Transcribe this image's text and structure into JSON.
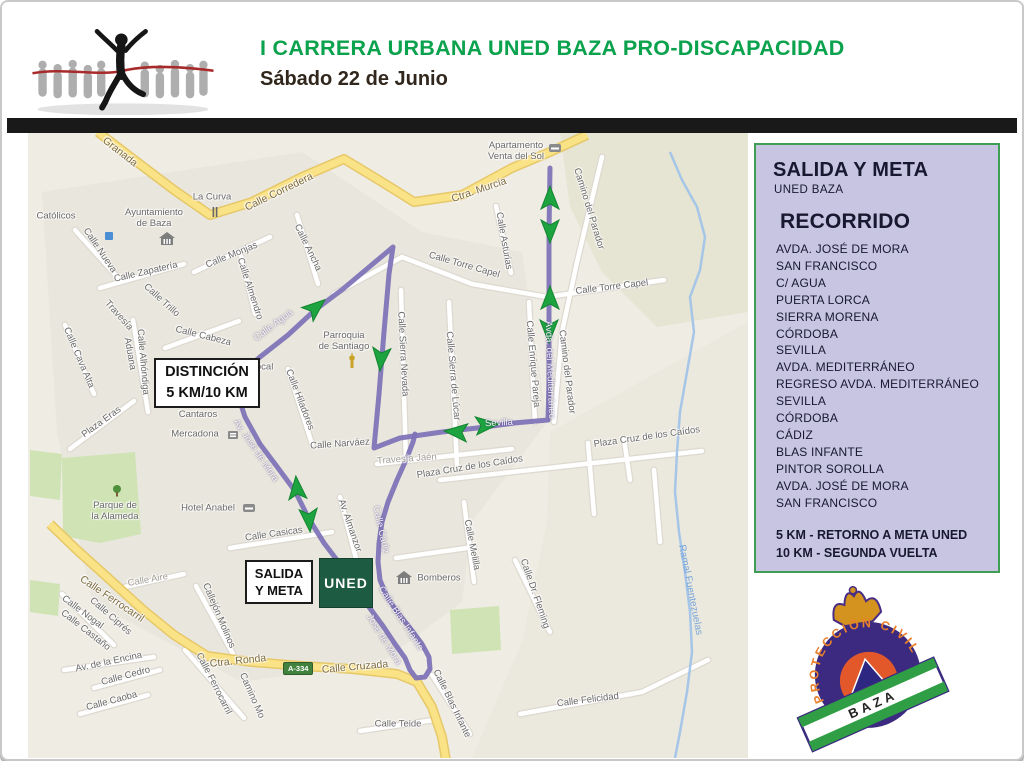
{
  "header": {
    "title": "I CARRERA URBANA UNED BAZA PRO-DISCAPACIDAD",
    "subtitle": "Sábado 22 de Junio"
  },
  "sidebar": {
    "heading": "SALIDA Y META",
    "subheading": "UNED BAZA",
    "recorrido_title": "RECORRIDO",
    "streets": [
      "AVDA. JOSÉ DE MORA",
      "SAN FRANCISCO",
      "C/ AGUA",
      "PUERTA LORCA",
      "SIERRA MORENA",
      "CÓRDOBA",
      "SEVILLA",
      "AVDA. MEDITERRÁNEO",
      "REGRESO AVDA. MEDITERRÁNEO",
      "SEVILLA",
      "CÓRDOBA",
      "CÁDIZ",
      "BLAS INFANTE",
      "PINTOR SOROLLA",
      "AVDA. JOSÉ DE MORA",
      "SAN FRANCISCO"
    ],
    "notes": [
      "5 KM - RETORNO A META UNED",
      "10 KM - SEGUNDA VUELTA"
    ]
  },
  "logo": {
    "arc_text": "PROTECCIÓN CIVIL",
    "banner_text": "BAZA"
  },
  "colors": {
    "title_green": "#0ba24d",
    "route_purple": "#7e72b7",
    "arrow_green": "#1da33f",
    "arrow_edge": "#12842f",
    "road_fill": "#fae286",
    "road_edge": "#e6c869",
    "street_white": "#ffffff",
    "street_edge": "#ddd9d0",
    "stream_blue": "#a6c6e8",
    "park_green": "#cfe3b4",
    "sidebar_bg": "#c7c5e2",
    "sidebar_border": "#3f9e53",
    "uned_green": "#1e5b43"
  },
  "map": {
    "boxes": {
      "distincion": {
        "line1": "DISTINCIÓN",
        "line2": "5 KM/10 KM"
      },
      "salida": {
        "line1": "SALIDA",
        "line2": "Y META"
      },
      "uned": "UNED",
      "road_badge": "A-334"
    },
    "labels": [
      {
        "t": "Granada",
        "x": 118,
        "y": 150,
        "r": 38,
        "c": "yellow"
      },
      {
        "t": "La Curva",
        "x": 210,
        "y": 196,
        "r": 0
      },
      {
        "t": "Calle Corredera",
        "x": 277,
        "y": 190,
        "r": -26,
        "c": "yellow"
      },
      {
        "t": "Ctra. Murcia",
        "x": 477,
        "y": 188,
        "r": -19,
        "c": "yellow"
      },
      {
        "t": "Católicos",
        "x": 54,
        "y": 215,
        "r": 0
      },
      {
        "t": "Ayuntamiento\nde Baza",
        "x": 152,
        "y": 217,
        "r": 0
      },
      {
        "t": "Calle Nueva",
        "x": 97,
        "y": 249,
        "r": 56
      },
      {
        "t": "Calle Zapatería",
        "x": 144,
        "y": 271,
        "r": -13
      },
      {
        "t": "Calle Monjas",
        "x": 230,
        "y": 254,
        "r": -22
      },
      {
        "t": "Calle Almendro",
        "x": 247,
        "y": 287,
        "r": 72
      },
      {
        "t": "Calle Ancha",
        "x": 305,
        "y": 246,
        "r": 64
      },
      {
        "t": "Calle Torre Capel",
        "x": 462,
        "y": 264,
        "r": 16
      },
      {
        "t": "Calle Torre Capel",
        "x": 610,
        "y": 286,
        "r": -7
      },
      {
        "t": "Calle Asturias",
        "x": 501,
        "y": 239,
        "r": 80
      },
      {
        "t": "Apartamento\nVenta del Sol",
        "x": 514,
        "y": 150,
        "r": 0
      },
      {
        "t": "Camino del Parador",
        "x": 586,
        "y": 207,
        "r": 73
      },
      {
        "t": "Camino del Parador",
        "x": 564,
        "y": 370,
        "r": 83
      },
      {
        "t": "Calle Enrique Pareja",
        "x": 530,
        "y": 362,
        "r": 85
      },
      {
        "t": "Plaza Cruz de los Caídos",
        "x": 645,
        "y": 436,
        "r": -8
      },
      {
        "t": "Plaza Cruz de los Caídos",
        "x": 468,
        "y": 466,
        "r": -9
      },
      {
        "t": "Calle Sierra Nevada",
        "x": 400,
        "y": 352,
        "r": 87
      },
      {
        "t": "Calle Sierra de Lúcar",
        "x": 450,
        "y": 374,
        "r": 85
      },
      {
        "t": "Parroquia\nde Santiago",
        "x": 342,
        "y": 340,
        "r": 0
      },
      {
        "t": "Calle Hiladores",
        "x": 297,
        "y": 398,
        "r": 69
      },
      {
        "t": "Calle Narváez",
        "x": 338,
        "y": 443,
        "r": -4
      },
      {
        "t": "Travesía Jaén",
        "x": 405,
        "y": 458,
        "r": -4,
        "c": "light"
      },
      {
        "t": "Av. Almanzor",
        "x": 347,
        "y": 524,
        "r": 71
      },
      {
        "t": "Calle Melilla",
        "x": 469,
        "y": 543,
        "r": 79
      },
      {
        "t": "Calle Cádiz",
        "x": 378,
        "y": 528,
        "r": 78,
        "c": "route"
      },
      {
        "t": "Calle Blas Infante",
        "x": 398,
        "y": 617,
        "r": 57,
        "c": "route"
      },
      {
        "t": "Jose de Mora",
        "x": 381,
        "y": 638,
        "r": 58,
        "c": "route"
      },
      {
        "t": "Av. José de Mora",
        "x": 253,
        "y": 449,
        "r": 56,
        "c": "route"
      },
      {
        "t": "Calle Agua",
        "x": 272,
        "y": 324,
        "r": -37,
        "c": "route"
      },
      {
        "t": "Sevilla",
        "x": 497,
        "y": 422,
        "r": -3,
        "c": "route"
      },
      {
        "t": "Avda. del Mediterráneo",
        "x": 547,
        "y": 368,
        "r": 88,
        "c": "route"
      },
      {
        "t": "Hotel Anabel",
        "x": 206,
        "y": 507,
        "r": 0
      },
      {
        "t": "Parque de\nla Alameda",
        "x": 113,
        "y": 510,
        "r": 0
      },
      {
        "t": "Mercadona",
        "x": 193,
        "y": 433,
        "r": 0
      },
      {
        "t": "Los\nCantaros",
        "x": 196,
        "y": 408,
        "r": 0
      },
      {
        "t": "Plaza Eras",
        "x": 100,
        "y": 421,
        "r": -36
      },
      {
        "t": "Calle Cava Alta",
        "x": 76,
        "y": 356,
        "r": 67
      },
      {
        "t": "Travesía",
        "x": 116,
        "y": 314,
        "r": 48
      },
      {
        "t": "Aduana",
        "x": 127,
        "y": 352,
        "r": 80
      },
      {
        "t": "Calle Trillo",
        "x": 159,
        "y": 299,
        "r": 42
      },
      {
        "t": "Calle Alhóndiga",
        "x": 140,
        "y": 360,
        "r": 85
      },
      {
        "t": "Calle Cabeza",
        "x": 201,
        "y": 335,
        "r": 14
      },
      {
        "t": "a Local",
        "x": 256,
        "y": 366,
        "r": 0
      },
      {
        "t": "za",
        "x": 245,
        "y": 377,
        "r": 0
      },
      {
        "t": "Calle Casicas",
        "x": 272,
        "y": 533,
        "r": -8
      },
      {
        "t": "Calle Aire",
        "x": 146,
        "y": 579,
        "r": -10,
        "c": "light"
      },
      {
        "t": "Callejón Molinos",
        "x": 216,
        "y": 614,
        "r": 67
      },
      {
        "t": "Calle Ferrocarril",
        "x": 110,
        "y": 597,
        "r": 34,
        "c": "yellow"
      },
      {
        "t": "Calle Ferrocarril",
        "x": 211,
        "y": 682,
        "r": 63
      },
      {
        "t": "Calle Nogal",
        "x": 80,
        "y": 611,
        "r": 37
      },
      {
        "t": "Calle Ciprés",
        "x": 108,
        "y": 615,
        "r": 41
      },
      {
        "t": "Calle Castaño",
        "x": 83,
        "y": 629,
        "r": 38
      },
      {
        "t": "Av. de la Encina",
        "x": 107,
        "y": 661,
        "r": -12
      },
      {
        "t": "Calle Cedro",
        "x": 124,
        "y": 675,
        "r": -15
      },
      {
        "t": "Calle Caoba",
        "x": 110,
        "y": 700,
        "r": -15
      },
      {
        "t": "Ctra. Ronda",
        "x": 236,
        "y": 659,
        "r": -6,
        "c": "yellow"
      },
      {
        "t": "Calle Cruzada",
        "x": 353,
        "y": 665,
        "r": -5,
        "c": "yellow"
      },
      {
        "t": "Camino Mo",
        "x": 249,
        "y": 694,
        "r": 66
      },
      {
        "t": "Calle Teide",
        "x": 396,
        "y": 723,
        "r": 0
      },
      {
        "t": "Calle Felicidad",
        "x": 586,
        "y": 699,
        "r": -7
      },
      {
        "t": "Calle Dr. Fleming",
        "x": 532,
        "y": 592,
        "r": 71
      },
      {
        "t": "Ramal Fuentezuelas",
        "x": 688,
        "y": 588,
        "r": 79,
        "c": "blue"
      },
      {
        "t": "Calle Blas Infante",
        "x": 449,
        "y": 702,
        "r": 64
      },
      {
        "t": "Bomberos",
        "x": 437,
        "y": 577,
        "r": 0
      }
    ],
    "icons": [
      {
        "k": "museum",
        "x": 165,
        "y": 237
      },
      {
        "k": "fork",
        "x": 213,
        "y": 210
      },
      {
        "k": "atm",
        "x": 107,
        "y": 234
      },
      {
        "k": "bed",
        "x": 553,
        "y": 146
      },
      {
        "k": "church",
        "x": 350,
        "y": 361
      },
      {
        "k": "bed",
        "x": 247,
        "y": 506
      },
      {
        "k": "tree",
        "x": 115,
        "y": 490
      },
      {
        "k": "cart",
        "x": 231,
        "y": 433
      },
      {
        "k": "museum",
        "x": 402,
        "y": 576
      }
    ],
    "geometry": {
      "regions": [
        {
          "fill": "#e6e4d2",
          "pts": [
            558,
            131,
            746,
            131,
            746,
            310,
            655,
            325,
            600,
            270,
            568,
            205
          ]
        },
        {
          "fill": "#ebe8de",
          "pts": [
            548,
            430,
            746,
            320,
            746,
            756,
            470,
            756,
            520,
            640,
            545,
            520
          ]
        },
        {
          "fill": "#e9e6dd",
          "pts": [
            40,
            190,
            300,
            150,
            420,
            230,
            520,
            250,
            545,
            420,
            470,
            520,
            460,
            600,
            380,
            660,
            240,
            680,
            90,
            600,
            55,
            430
          ]
        }
      ],
      "parks": [
        [
          60,
          456,
          133,
          450,
          139,
          532,
          98,
          541,
          61,
          534
        ],
        [
          28,
          578,
          58,
          582,
          56,
          614,
          28,
          610
        ],
        [
          448,
          608,
          497,
          604,
          499,
          648,
          450,
          652
        ],
        [
          28,
          448,
          60,
          452,
          58,
          498,
          28,
          494
        ]
      ],
      "streets": [
        [
          399,
          288,
          404,
          460
        ],
        [
          447,
          300,
          455,
          463
        ],
        [
          527,
          300,
          533,
          420
        ],
        [
          600,
          155,
          575,
          260,
          560,
          330,
          552,
          420
        ],
        [
          332,
          292,
          400,
          255,
          470,
          282,
          545,
          295,
          662,
          278
        ],
        [
          375,
          462,
          510,
          447
        ],
        [
          438,
          478,
          700,
          449
        ],
        [
          462,
          500,
          472,
          580
        ],
        [
          338,
          495,
          358,
          572
        ],
        [
          228,
          546,
          330,
          530
        ],
        [
          286,
          367,
          310,
          442
        ],
        [
          98,
          286,
          182,
          262
        ],
        [
          192,
          270,
          268,
          235
        ],
        [
          73,
          228,
          117,
          277
        ],
        [
          295,
          213,
          316,
          282
        ],
        [
          163,
          346,
          237,
          319
        ],
        [
          131,
          318,
          146,
          410
        ],
        [
          494,
          204,
          509,
          271
        ],
        [
          239,
          254,
          253,
          312
        ],
        [
          513,
          558,
          548,
          630
        ],
        [
          518,
          712,
          640,
          690,
          706,
          658
        ],
        [
          430,
          673,
          468,
          732
        ],
        [
          183,
          648,
          242,
          716
        ],
        [
          118,
          586,
          182,
          572
        ],
        [
          194,
          584,
          231,
          652
        ],
        [
          63,
          323,
          92,
          392
        ],
        [
          68,
          447,
          132,
          399
        ],
        [
          62,
          668,
          152,
          655
        ],
        [
          92,
          686,
          158,
          668
        ],
        [
          78,
          712,
          146,
          693
        ],
        [
          358,
          729,
          432,
          718
        ],
        [
          394,
          556,
          472,
          545
        ],
        [
          586,
          441,
          592,
          512
        ],
        [
          622,
          437,
          628,
          478
        ],
        [
          652,
          468,
          658,
          540
        ],
        [
          60,
          592,
          112,
          643
        ]
      ],
      "roads": [
        [
          96,
          130,
          135,
          160,
          172,
          188,
          208,
          213,
          250,
          200,
          300,
          175,
          342,
          157,
          380,
          180,
          412,
          200,
          460,
          193,
          510,
          166,
          548,
          150,
          585,
          133
        ],
        [
          48,
          522,
          75,
          548,
          105,
          575,
          140,
          607,
          172,
          633,
          205,
          654
        ],
        [
          205,
          654,
          250,
          660,
          300,
          664,
          350,
          667,
          395,
          672,
          415,
          680,
          430,
          705,
          440,
          735,
          444,
          758
        ]
      ],
      "stream": [
        668,
        150,
        680,
        178,
        695,
        205,
        703,
        235,
        698,
        268,
        688,
        295,
        692,
        330,
        685,
        370,
        678,
        410,
        675,
        450,
        673,
        490,
        677,
        530,
        683,
        570,
        688,
        610,
        690,
        650,
        685,
        690,
        678,
        730,
        673,
        756
      ],
      "route": [
        [
          231,
          378,
          258,
          355,
          286,
          333,
          313,
          308,
          341,
          287,
          366,
          266,
          391,
          245,
          387,
          272,
          382,
          330,
          377,
          392,
          372,
          446,
          398,
          436,
          440,
          430,
          475,
          426,
          512,
          421,
          546,
          418,
          547,
          380,
          547,
          300,
          547,
          230,
          548,
          166
        ],
        [
          231,
          378,
          243,
          415,
          258,
          442,
          276,
          466,
          293,
          489,
          307,
          517,
          322,
          541,
          338,
          562,
          353,
          584,
          367,
          605,
          381,
          624,
          393,
          642,
          403,
          656,
          408,
          668,
          414,
          676,
          423,
          675,
          428,
          667,
          427,
          655,
          420,
          642,
          408,
          626,
          396,
          611,
          385,
          595,
          378,
          578,
          376,
          560,
          377,
          541,
          380,
          520,
          386,
          500,
          395,
          478,
          404,
          458,
          411,
          440,
          413,
          432
        ]
      ],
      "arrows": [
        {
          "x": 313,
          "y": 306,
          "a": -40
        },
        {
          "x": 379,
          "y": 356,
          "a": 95
        },
        {
          "x": 295,
          "y": 487,
          "a": -95
        },
        {
          "x": 307,
          "y": 517,
          "a": 85
        },
        {
          "x": 455,
          "y": 430,
          "a": 185
        },
        {
          "x": 484,
          "y": 423,
          "a": -5
        },
        {
          "x": 548,
          "y": 197,
          "a": -90
        },
        {
          "x": 548,
          "y": 228,
          "a": 90
        },
        {
          "x": 548,
          "y": 297,
          "a": -90
        },
        {
          "x": 547,
          "y": 328,
          "a": 90
        }
      ]
    }
  }
}
